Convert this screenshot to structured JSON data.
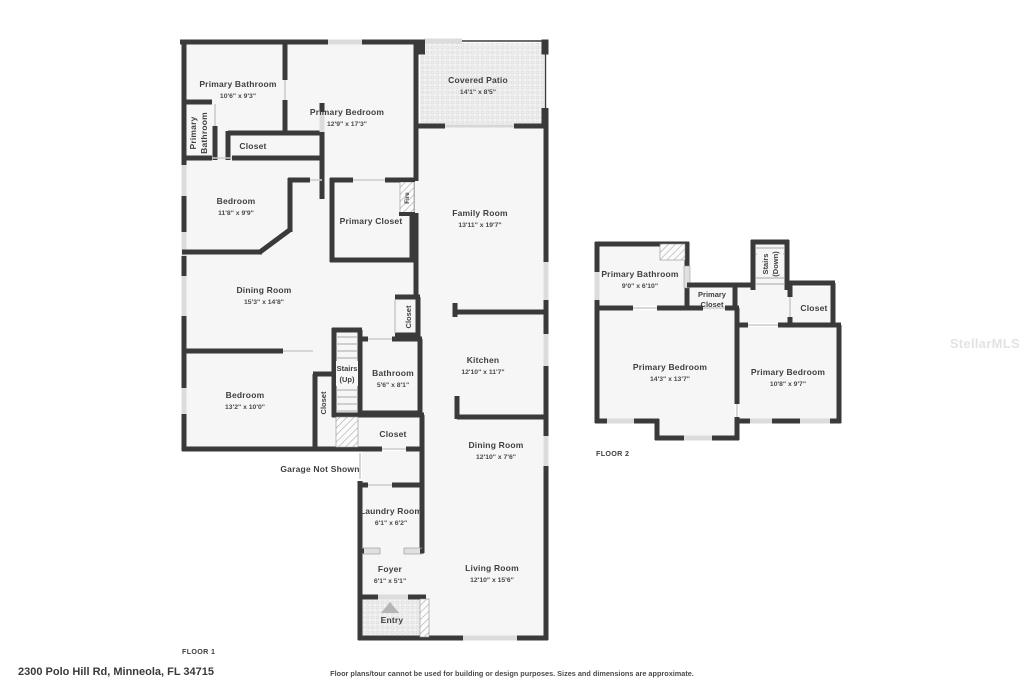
{
  "address": "2300 Polo Hill Rd, Minneola, FL 34715",
  "disclaimer": "Floor plans/tour cannot be used for building or design purposes. Sizes and dimensions are approximate.",
  "watermark": "StellarMLS",
  "colors": {
    "wall": "#3a3a3a",
    "room_fill": "#f6f6f6",
    "window": "#dcdcdc",
    "text": "#3f3f3f",
    "watermark": "#e3e3e3"
  },
  "floor1": {
    "label": "FLOOR 1",
    "garage_note": "Garage Not Shown",
    "rooms": {
      "primary_bathroom": {
        "name": "Primary Bathroom",
        "dims": "10'6\" x 9'3\""
      },
      "primary_bathroom_side": {
        "line1": "Primary",
        "line2": "Bathroom"
      },
      "closet_a": {
        "name": "Closet"
      },
      "primary_bedroom": {
        "name": "Primary Bedroom",
        "dims": "12'9\" x 17'3\""
      },
      "covered_patio": {
        "name": "Covered Patio",
        "dims": "14'1\" x 8'5\""
      },
      "bedroom_a": {
        "name": "Bedroom",
        "dims": "11'8\" x 9'9\""
      },
      "primary_closet": {
        "name": "Primary Closet"
      },
      "fireplace": {
        "name": "Fire"
      },
      "family_room": {
        "name": "Family Room",
        "dims": "13'11\" x 19'7\""
      },
      "dining_room_a": {
        "name": "Dining Room",
        "dims": "15'3\" x 14'8\""
      },
      "closet_b": {
        "name": "Closet"
      },
      "stairs_up": {
        "line1": "Stairs",
        "line2": "(Up)"
      },
      "bathroom": {
        "name": "Bathroom",
        "dims": "5'6\" x 8'1\""
      },
      "kitchen": {
        "name": "Kitchen",
        "dims": "12'10\" x 11'7\""
      },
      "bedroom_b": {
        "name": "Bedroom",
        "dims": "13'2\" x 10'0\""
      },
      "closet_c": {
        "name": "Closet"
      },
      "closet_d": {
        "name": "Closet"
      },
      "dining_room_b": {
        "name": "Dining Room",
        "dims": "12'10\" x 7'6\""
      },
      "laundry_room": {
        "name": "Laundry Room",
        "dims": "6'1\" x 6'2\""
      },
      "foyer": {
        "name": "Foyer",
        "dims": "6'1\" x 5'1\""
      },
      "living_room": {
        "name": "Living Room",
        "dims": "12'10\" x 15'6\""
      },
      "entry": {
        "name": "Entry"
      }
    }
  },
  "floor2": {
    "label": "FLOOR 2",
    "rooms": {
      "primary_bathroom": {
        "name": "Primary Bathroom",
        "dims": "9'0\" x 6'10\""
      },
      "primary_closet": {
        "line1": "Primary",
        "line2": "Closet"
      },
      "stairs_down": {
        "line1": "Stairs",
        "line2": "(Down)"
      },
      "closet": {
        "name": "Closet"
      },
      "primary_bedroom_a": {
        "name": "Primary Bedroom",
        "dims": "14'3\" x 13'7\""
      },
      "primary_bedroom_b": {
        "name": "Primary Bedroom",
        "dims": "10'8\" x 9'7\""
      }
    }
  }
}
